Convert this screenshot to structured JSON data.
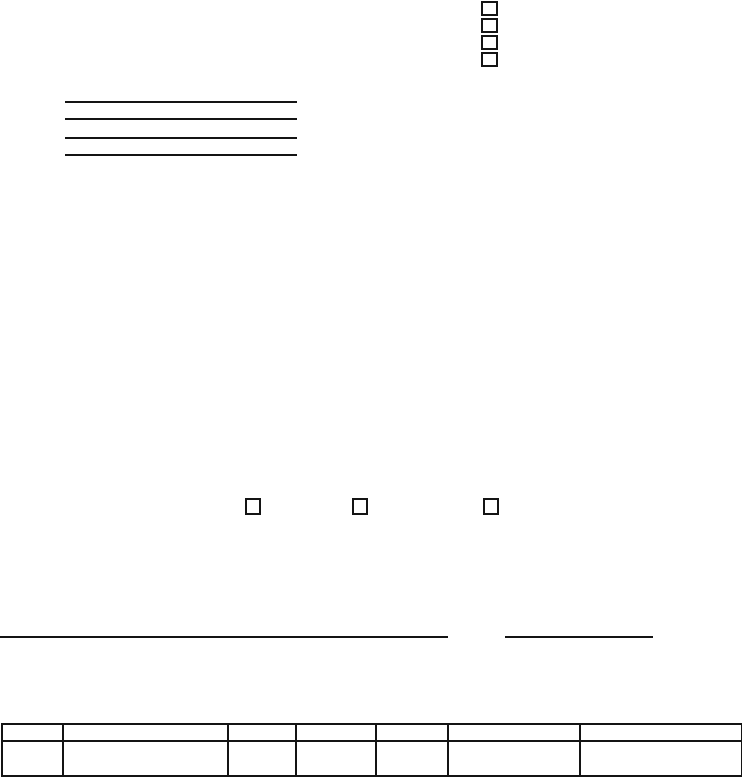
{
  "page": {
    "kind": "Blank scanned form page",
    "background": "#ffffff",
    "ink": "#141414"
  },
  "top_checkbox_stack": {
    "count": 4,
    "checked": [
      false,
      false,
      false,
      false
    ]
  },
  "ruled_lines": {
    "count": 4
  },
  "option_checkboxes": {
    "count": 3,
    "checked": [
      false,
      false,
      false
    ]
  },
  "footer_lines": {
    "count": 2
  },
  "table": {
    "column_count": 7,
    "header": [
      "",
      "",
      "",
      "",
      "",
      "",
      ""
    ],
    "rows": [
      [
        "",
        "",
        "",
        "",
        "",
        "",
        ""
      ]
    ]
  }
}
